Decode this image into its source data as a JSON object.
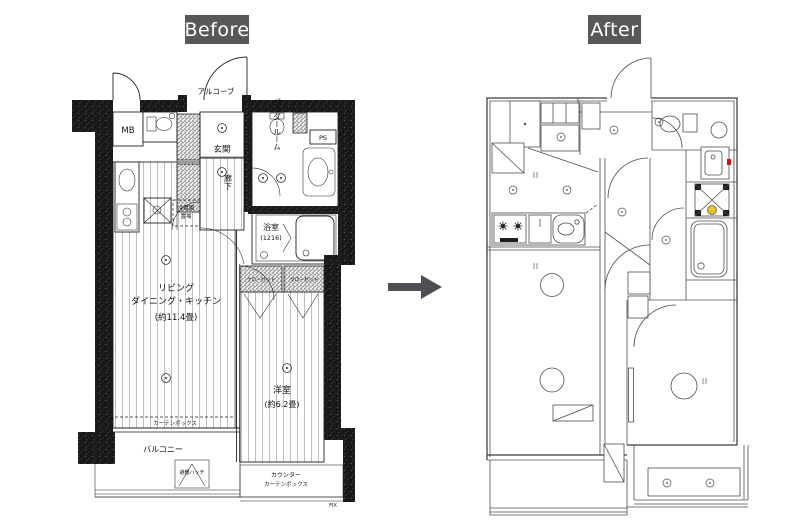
{
  "header": {
    "before_label": "Before",
    "after_label": "After"
  },
  "theme": {
    "label_bg": "#57585a",
    "label_fg": "#ffffff",
    "arrow_color": "#4d4f52",
    "before_line_color": "#222222",
    "after_line_color": "#4c4c4c",
    "accent_red": "#cc1414",
    "accent_yellow": "#e8c52a"
  },
  "before_plan": {
    "alcove": "アルコーブ",
    "meter_box": "MB",
    "entrance": "玄関",
    "corridor": "廊下",
    "powder_room": "パウダールーム",
    "pipe_space": "PS",
    "bathroom": "浴室",
    "bathroom_size": "(1216)",
    "fridge_line1": "冷蔵庫",
    "fridge_line2": "置場",
    "ldk_line1": "リビング",
    "ldk_line2": "ダイニング・キッチン",
    "ldk_size": "(約11.4畳)",
    "curtain_box": "カーテンボックス",
    "closet_left": "クローゼット",
    "closet_right": "クローゼット",
    "western_room": "洋室",
    "western_room_size": "(約6.2畳)",
    "balcony": "バルコニー",
    "evac_hatch": "避難ハッチ",
    "counter": "カウンター",
    "counter_curtain_box": "カーテンボックス",
    "fix_window": "FIX"
  }
}
